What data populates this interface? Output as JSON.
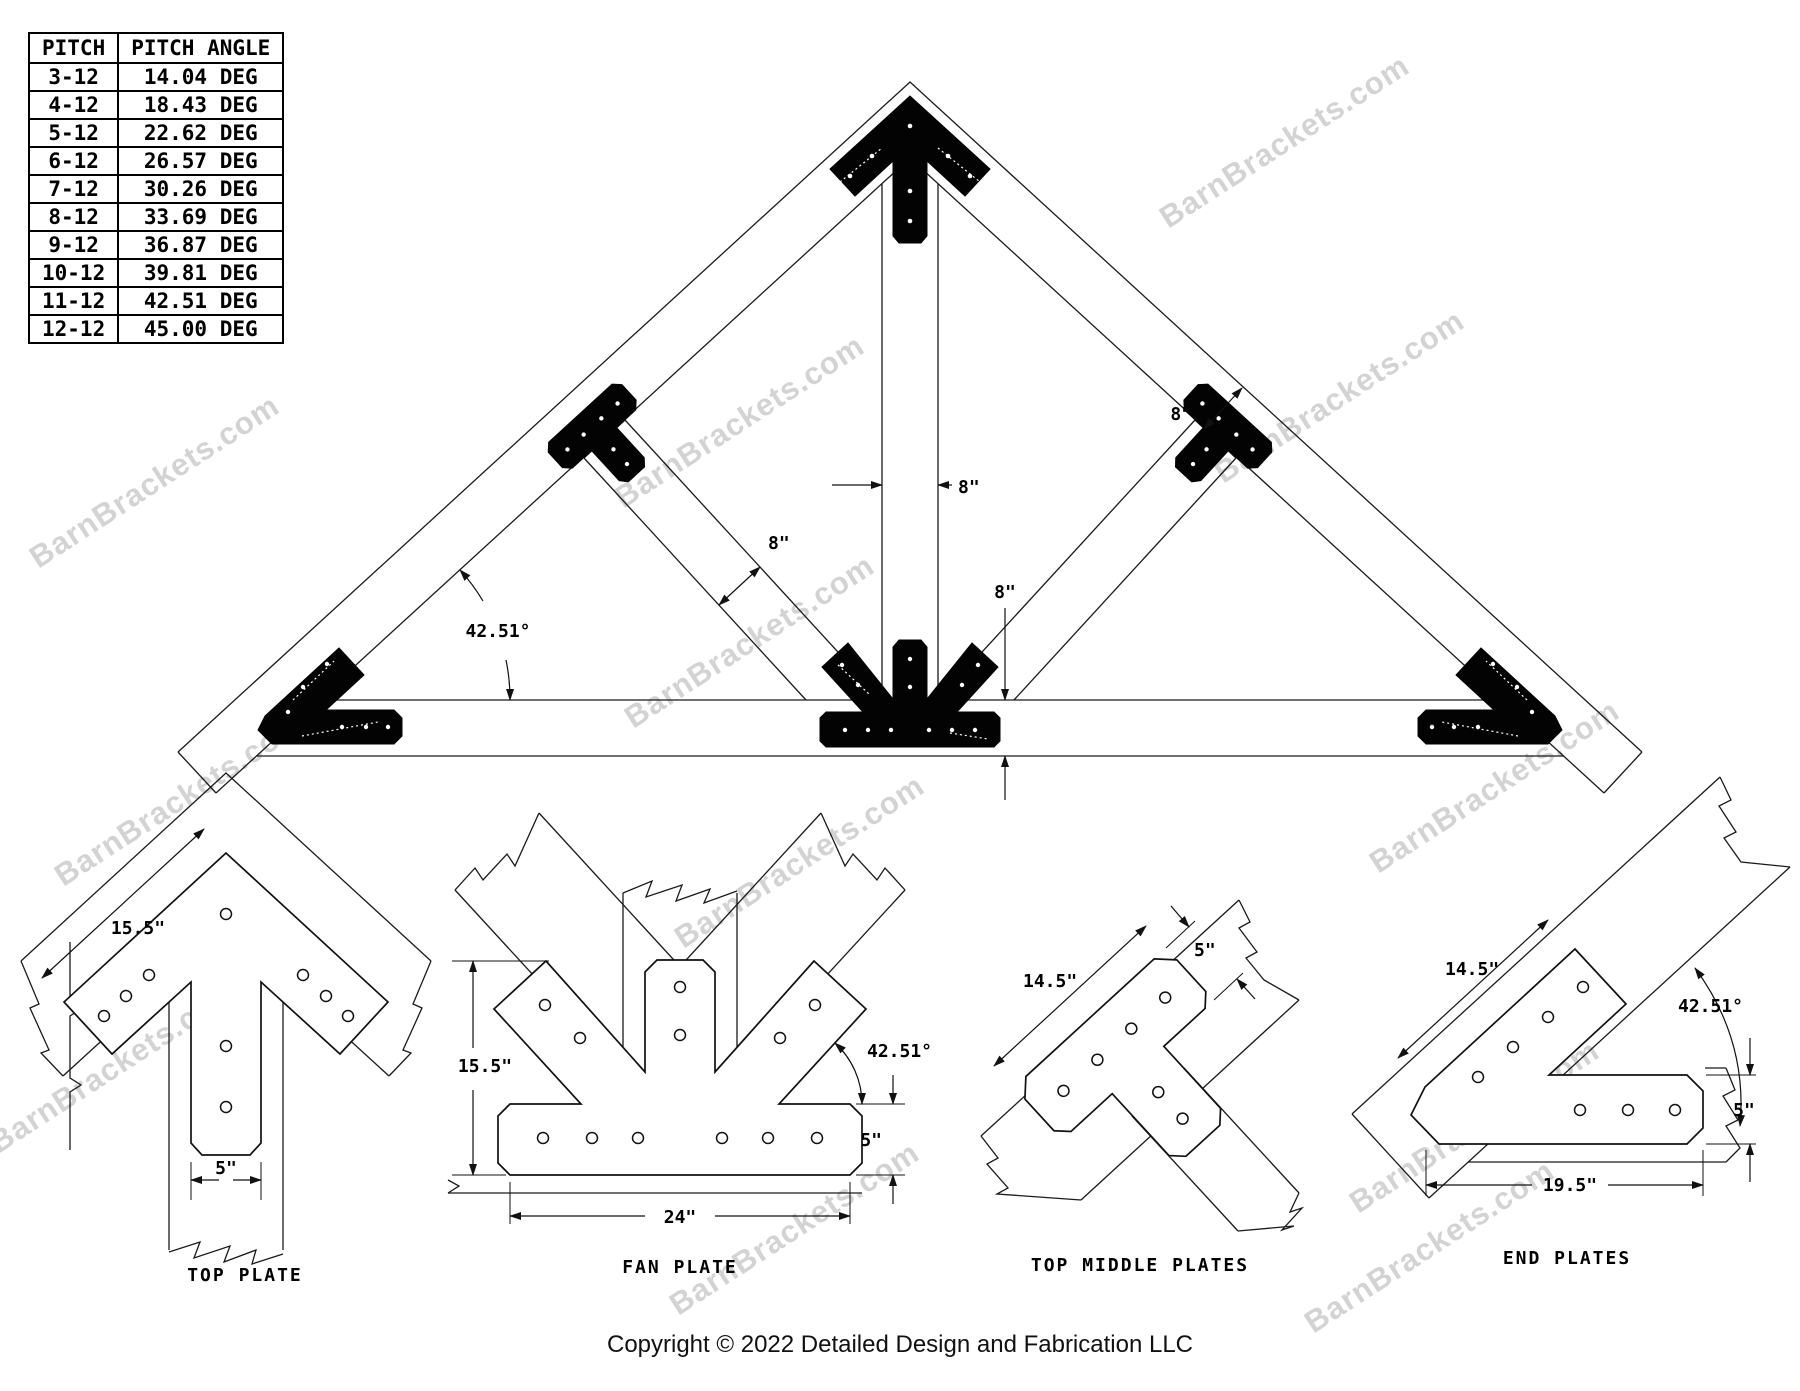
{
  "watermark": {
    "text": "BarnBrackets.com"
  },
  "pitch_table": {
    "headers": [
      "PITCH",
      "PITCH ANGLE"
    ],
    "rows": [
      [
        "3-12",
        "14.04 DEG"
      ],
      [
        "4-12",
        "18.43 DEG"
      ],
      [
        "5-12",
        "22.62 DEG"
      ],
      [
        "6-12",
        "26.57 DEG"
      ],
      [
        "7-12",
        "30.26 DEG"
      ],
      [
        "8-12",
        "33.69 DEG"
      ],
      [
        "9-12",
        "36.87 DEG"
      ],
      [
        "10-12",
        "39.81 DEG"
      ],
      [
        "11-12",
        "42.51 DEG"
      ],
      [
        "12-12",
        "45.00 DEG"
      ]
    ]
  },
  "truss": {
    "pitch_angle": "42.51°",
    "king_post_width": "8\"",
    "strut_width": "8\"",
    "top_chord_width": "8\"",
    "bottom_chord_depth": "8\""
  },
  "details": {
    "top_plate": {
      "label": "TOP PLATE",
      "edge_length": "15.5\"",
      "leg_width": "5\""
    },
    "fan_plate": {
      "label": "FAN PLATE",
      "height": "15.5\"",
      "base_length": "24\"",
      "base_width": "5\"",
      "angle": "42.51°"
    },
    "top_middle": {
      "label": "TOP MIDDLE PLATES",
      "bar_length": "14.5\"",
      "bar_width": "5\""
    },
    "end_plates": {
      "label": "END PLATES",
      "arm_length": "14.5\"",
      "base_length": "19.5\"",
      "base_width": "5\"",
      "angle": "42.51°"
    }
  },
  "footer": {
    "copyright": "Copyright © 2022 Detailed Design and Fabrication LLC"
  }
}
